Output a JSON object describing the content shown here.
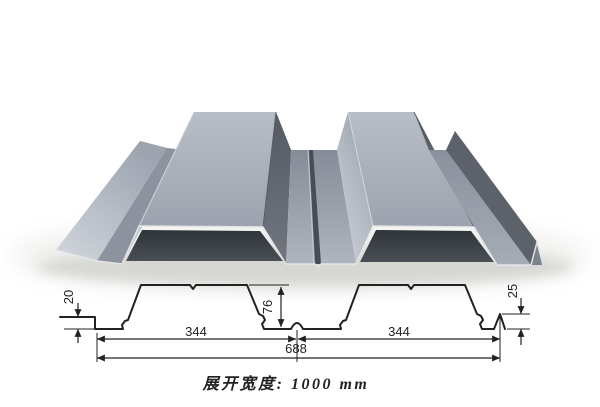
{
  "colors": {
    "background": "#ffffff",
    "line": "#222222",
    "steel_lit": "#c6cbd3",
    "steel_top": "#a2a8b3",
    "steel_mid": "#8d939e",
    "steel_back": "#a6acb6",
    "steel_dark": "#666b75",
    "steel_dark_deep": "#5c616a",
    "groove": "#484c54",
    "cavity": "#383c43",
    "edge_light": "#e4e7ea",
    "ground_shadow": "#d6d6d3"
  },
  "drawing": {
    "dim_left_height": "20",
    "dim_rib_height": "76",
    "dim_lip_height": "25",
    "dim_span_left": "344",
    "dim_span_right": "344",
    "dim_total_span": "688",
    "caption": "展开宽度: 1000 mm"
  }
}
